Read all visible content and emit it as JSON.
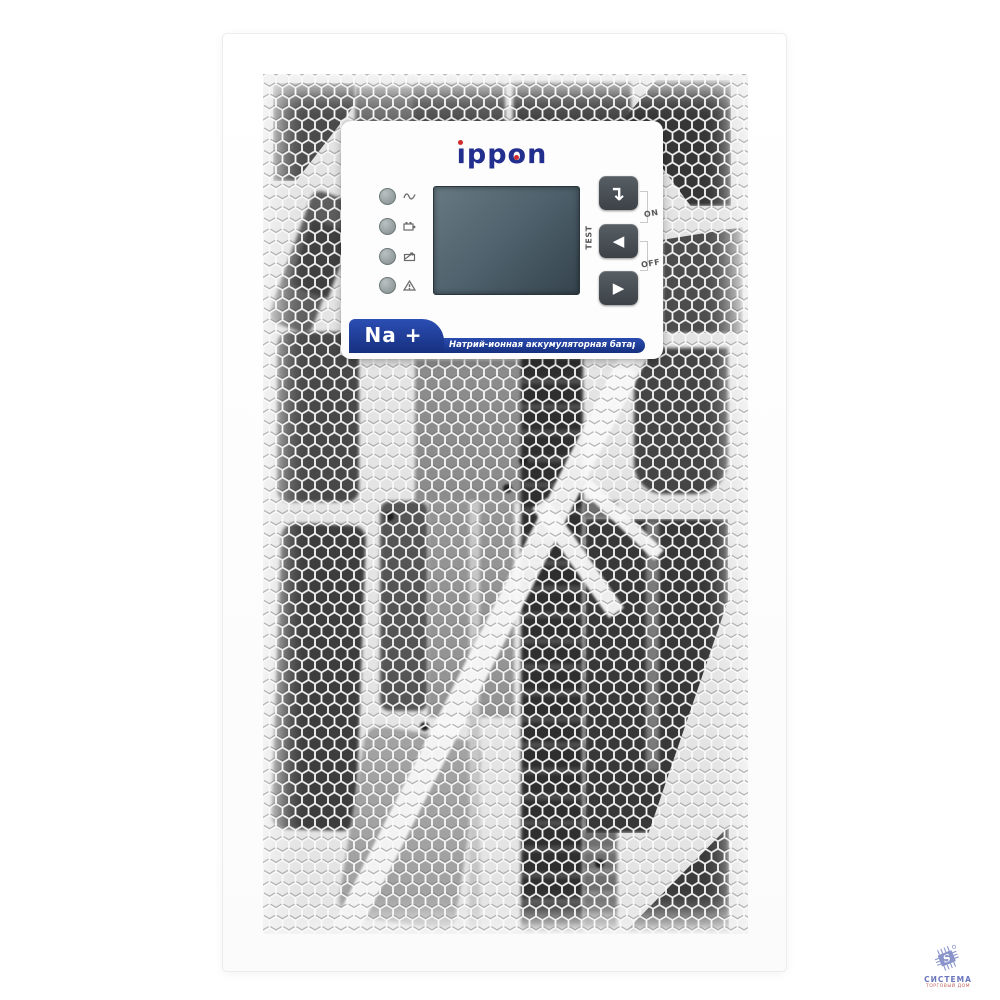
{
  "product": {
    "brand": {
      "name": "ippon",
      "dotless_i": "ı",
      "rest": "ppon"
    },
    "panel": {
      "leds": [
        {
          "label": "line-mode",
          "icon": "sine-wave-icon"
        },
        {
          "label": "battery-mode",
          "icon": "battery-icon"
        },
        {
          "label": "bypass-mode",
          "icon": "bypass-icon"
        },
        {
          "label": "fault",
          "icon": "warning-icon"
        }
      ],
      "buttons": {
        "enter": {
          "glyph": "↵"
        },
        "up": {
          "glyph": "◀"
        },
        "down": {
          "glyph": "▶"
        }
      },
      "labels": {
        "test": "TEST",
        "on": "ON",
        "off": "OFF"
      },
      "banner": {
        "badge": "Na +",
        "description": "Натрий-ионная аккумуляторная батарея"
      },
      "display": {
        "type": "lcd"
      }
    }
  },
  "watermark": {
    "title": "СИСТЕМА",
    "subtitle": "ТОРГОВЫЙ ДОМ",
    "icon": "chip-icon",
    "chip_letter": "S"
  },
  "colors": {
    "banner_blue": "#1d3f9e",
    "logo_blue": "#232f8e",
    "logo_red": "#d12b2b",
    "lcd_slate": "#44545f",
    "button_dark": "#474e54",
    "watermark_blue": "#7c87c3",
    "mesh_white": "#f9f9f9"
  }
}
